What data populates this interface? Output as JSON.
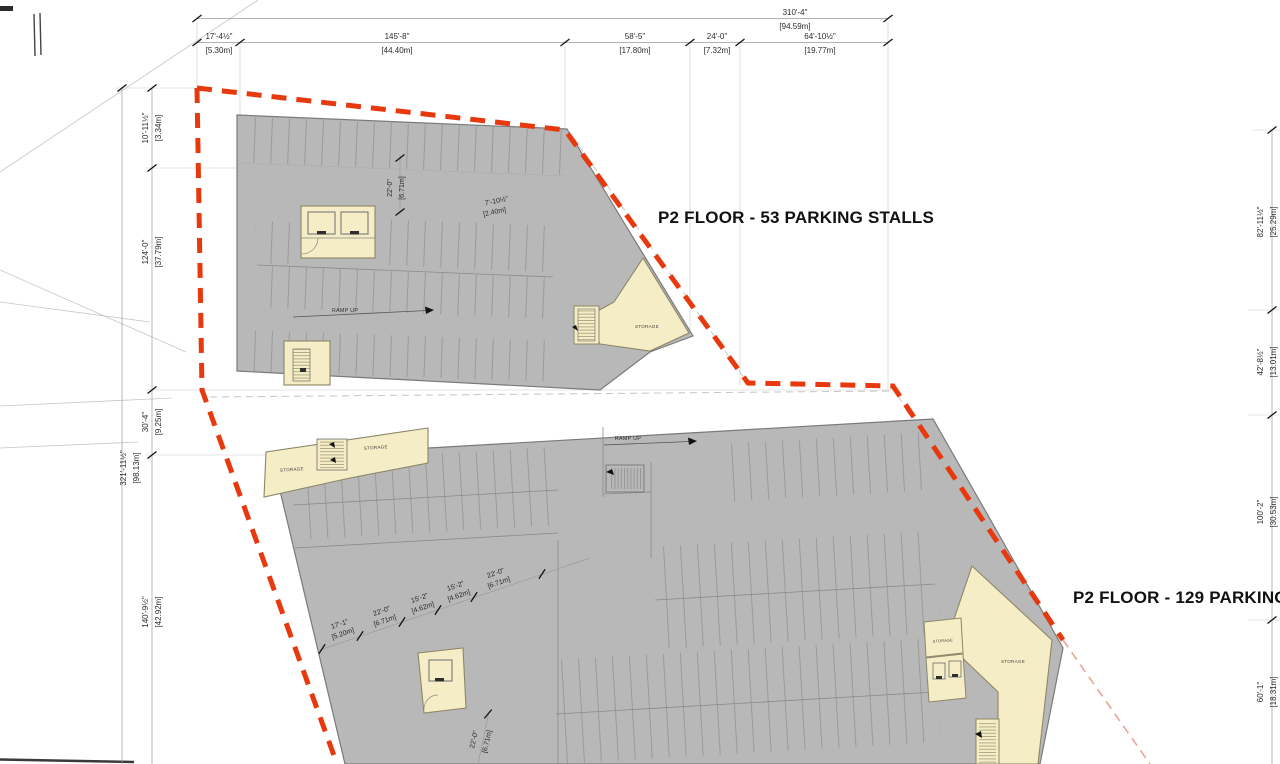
{
  "titles": {
    "upper": "P2 FLOOR - 53 PARKING STALLS",
    "lower": "P2 FLOOR - 129 PARKING S"
  },
  "labels": {
    "ramp_up": "RAMP UP",
    "storage": "STORAGE"
  },
  "colors": {
    "property_line": "#E8380D",
    "floor_fill": "#B8B8B8",
    "floor_outline": "#7A7A7A",
    "room_fill": "#F4EDC6",
    "room_outline": "#8D8668",
    "dim_text": "#2B2B2B"
  },
  "dims": {
    "top_overall": {
      "ft": "310'-4\"",
      "m": "[94.59m]"
    },
    "top_segments": [
      {
        "ft": "17'-4½\"",
        "m": "[5.30m]"
      },
      {
        "ft": "145'-8\"",
        "m": "[44.40m]"
      },
      {
        "ft": "58'-5\"",
        "m": "[17.80m]"
      },
      {
        "ft": "24'-0\"",
        "m": "[7.32m]"
      },
      {
        "ft": "64'-10½\"",
        "m": "[19.77m]"
      }
    ],
    "left_overall": {
      "ft": "321'-11½\"",
      "m": "[98.13m]"
    },
    "left": [
      {
        "ft": "10'-11½\"",
        "m": "[3.34m]"
      },
      {
        "ft": "124'-0\"",
        "m": "[37.79m]"
      },
      {
        "ft": "30'-4\"",
        "m": "[9.25m]"
      },
      {
        "ft": "140'-9½\"",
        "m": "[42.92m]"
      }
    ],
    "right": [
      {
        "ft": "82'-11½\"",
        "m": "[25.29m]"
      },
      {
        "ft": "42'-8½\"",
        "m": "[13.01m]"
      },
      {
        "ft": "100'-2\"",
        "m": "[30.53m]"
      },
      {
        "ft": "60'-1\"",
        "m": "[18.31m]"
      }
    ],
    "upper_inner": [
      {
        "ft": "22'-0\"",
        "m": "[6.71m]"
      },
      {
        "ft": "7'-10½\"",
        "m": "[2.40m]"
      }
    ],
    "lower_chain": [
      {
        "ft": "17'-1\"",
        "m": "[5.20m]"
      },
      {
        "ft": "22'-0\"",
        "m": "[6.71m]"
      },
      {
        "ft": "15'-2\"",
        "m": "[4.62m]"
      },
      {
        "ft": "15'-2\"",
        "m": "[4.62m]"
      },
      {
        "ft": "22'-0\"",
        "m": "[6.71m]"
      }
    ],
    "lower_vert": {
      "ft": "22'-0\"",
      "m": "[6.71m]"
    }
  }
}
